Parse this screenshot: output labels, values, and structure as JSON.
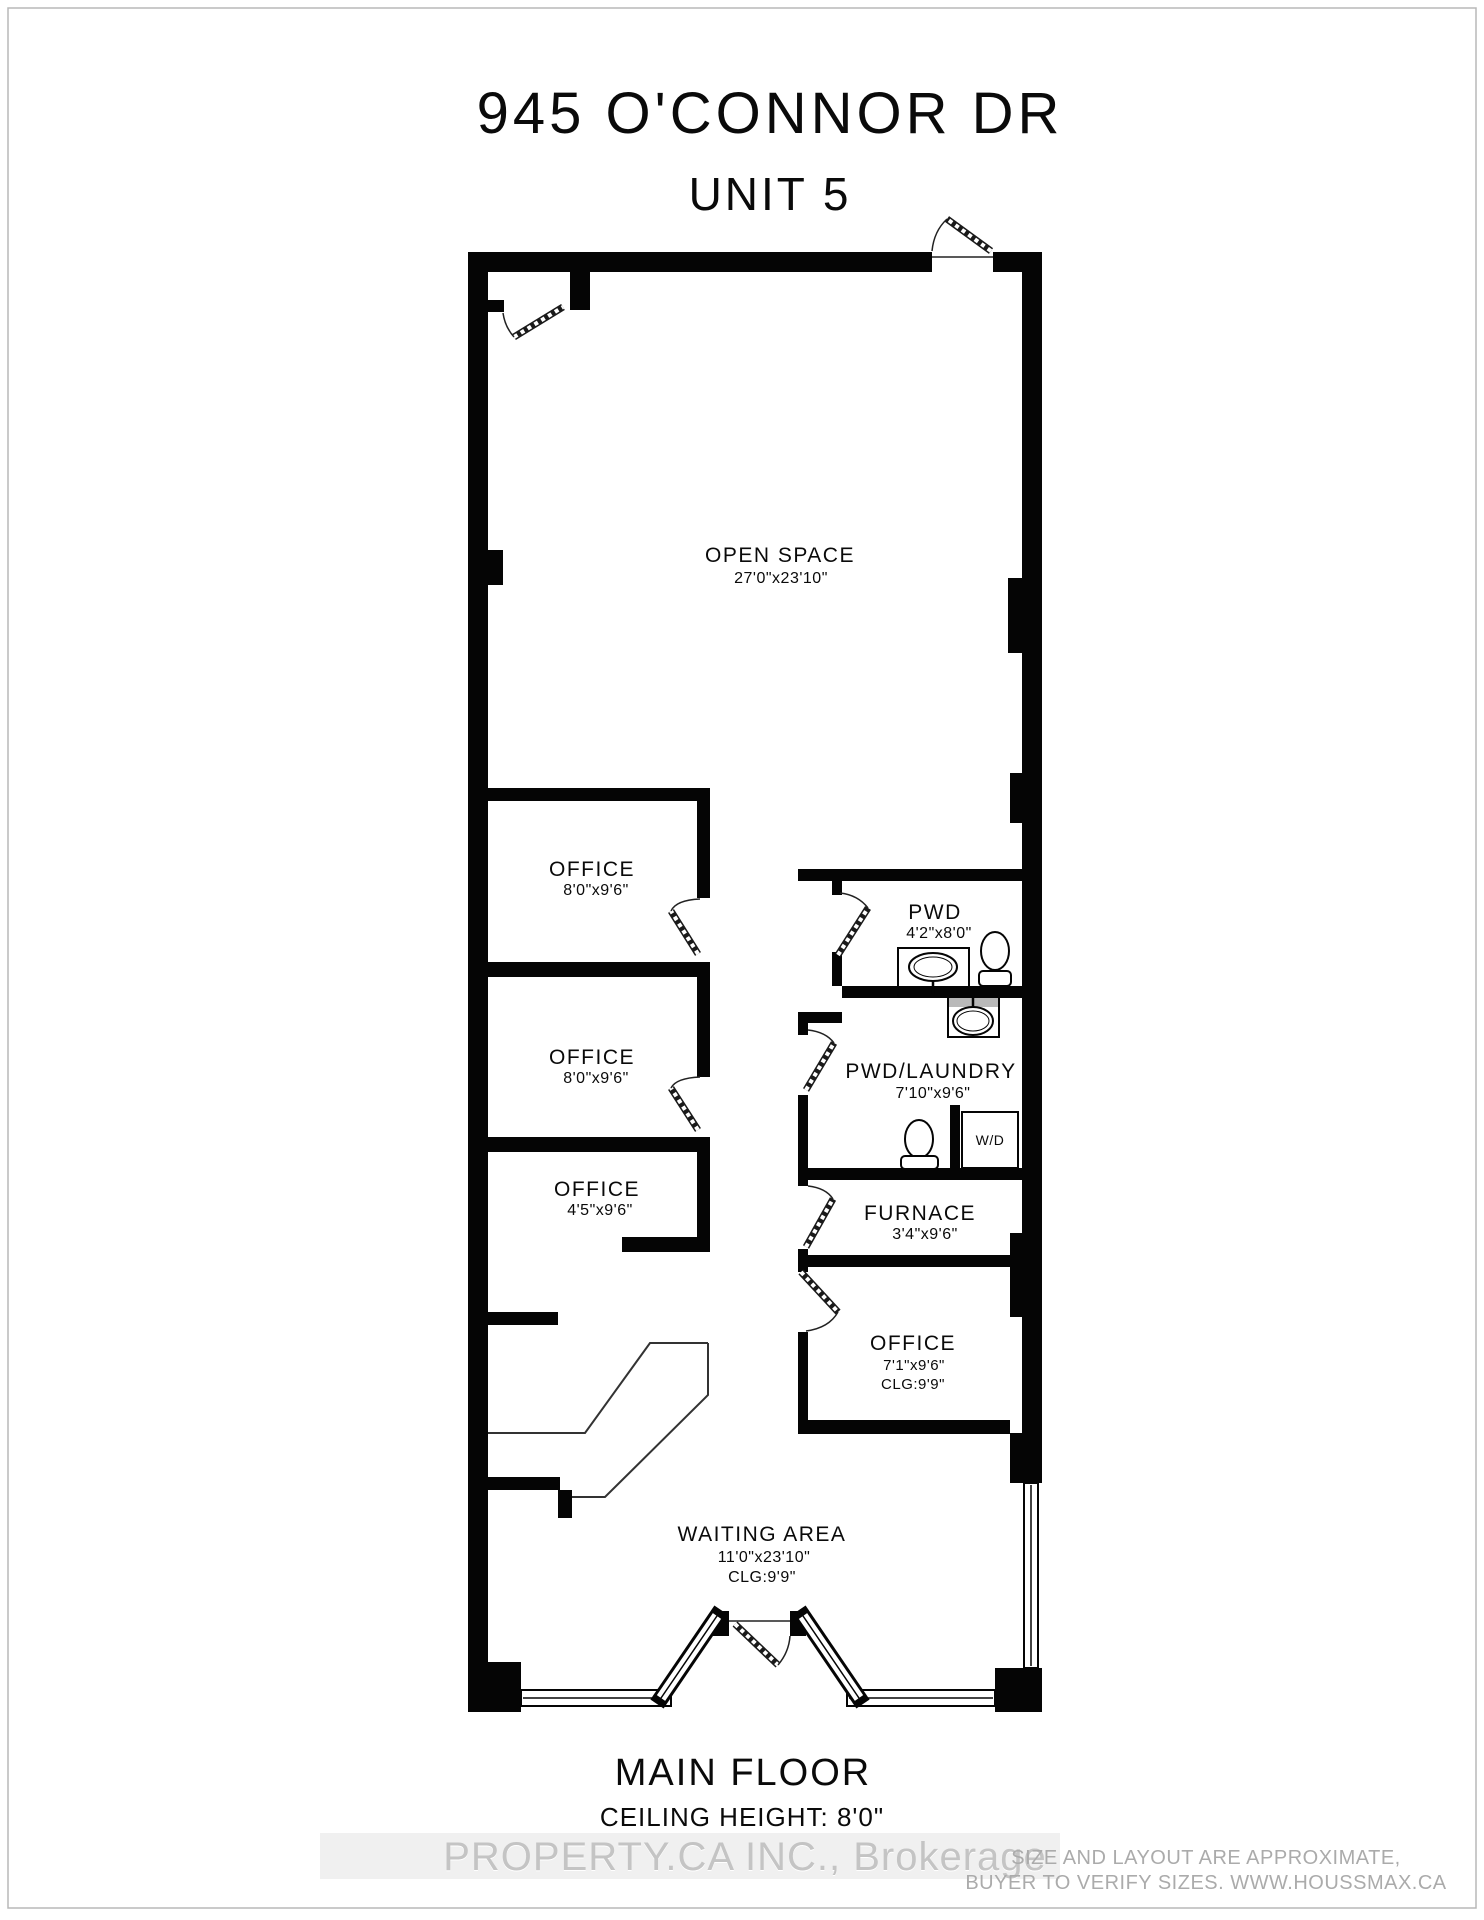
{
  "title": {
    "address": "945 O'CONNOR DR",
    "unit": "UNIT 5"
  },
  "rooms": {
    "open_space": {
      "name": "OPEN SPACE",
      "dims": "27'0\"x23'10\""
    },
    "office1": {
      "name": "OFFICE",
      "dims": "8'0\"x9'6\""
    },
    "office2": {
      "name": "OFFICE",
      "dims": "8'0\"x9'6\""
    },
    "office3": {
      "name": "OFFICE",
      "dims": "4'5\"x9'6\""
    },
    "pwd": {
      "name": "PWD",
      "dims": "4'2\"x8'0\""
    },
    "pwd_laundry": {
      "name": "PWD/LAUNDRY",
      "dims": "7'10\"x9'6\""
    },
    "furnace": {
      "name": "FURNACE",
      "dims": "3'4\"x9'6\""
    },
    "office4": {
      "name": "OFFICE",
      "dims": "7'1\"x9'6\"",
      "clg": "CLG:9'9\""
    },
    "waiting": {
      "name": "WAITING AREA",
      "dims": "11'0\"x23'10\"",
      "clg": "CLG:9'9\""
    }
  },
  "fixtures": {
    "washer_dryer": "W/D"
  },
  "footer": {
    "floor": "MAIN FLOOR",
    "ceiling": "CEILING HEIGHT: 8'0\""
  },
  "watermark": "PROPERTY.CA INC., Brokerage",
  "disclaimer": {
    "line1": "SIZE AND LAYOUT ARE APPROXIMATE,",
    "line2": "BUYER TO VERIFY SIZES. WWW.HOUSSMAX.CA"
  },
  "colors": {
    "wall": "#050505",
    "watermark_grey": "#c4c4c4",
    "disclaimer_grey": "#ababab"
  }
}
